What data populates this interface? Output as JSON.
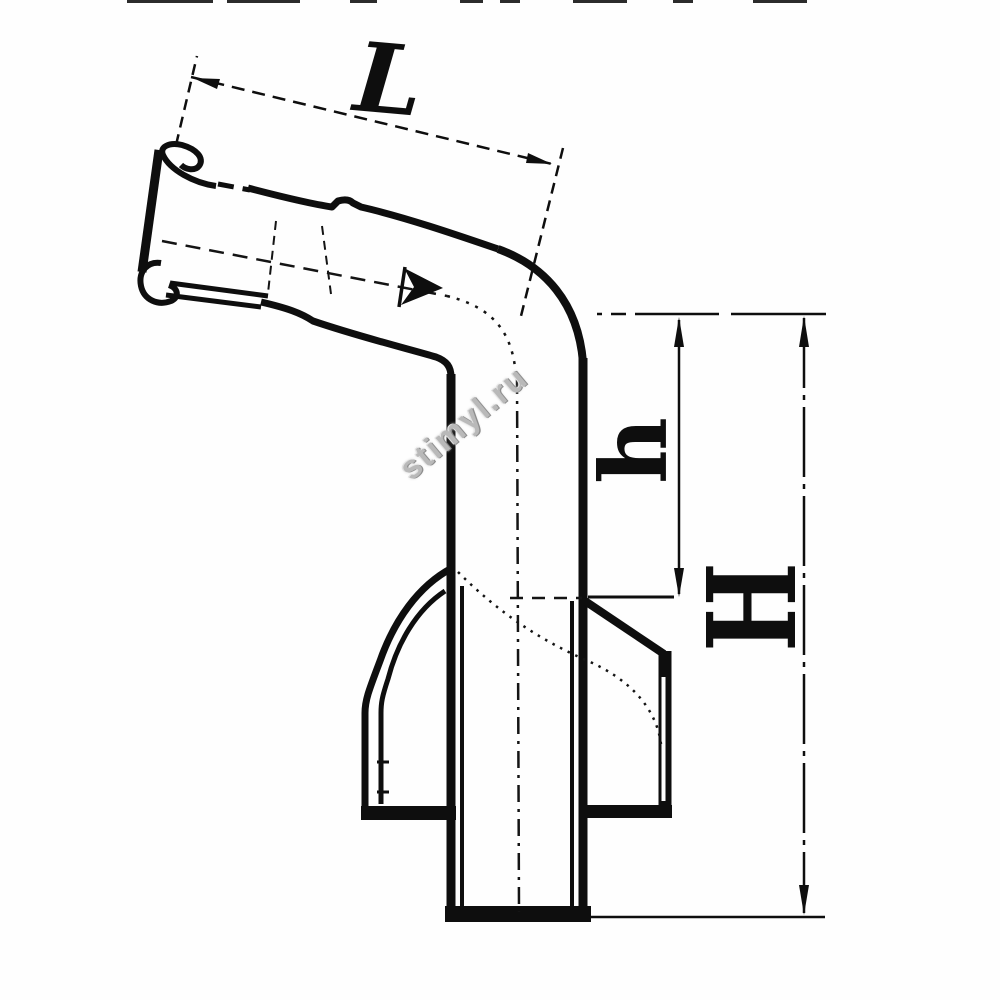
{
  "drawing": {
    "type": "technical-dimension-drawing",
    "subject": "angled drain pipe fitting, side section view",
    "labels": {
      "L": "L",
      "h": "h",
      "H": "H"
    },
    "watermark": {
      "text": "stimyl.ru",
      "color": "#b9b9b9"
    },
    "colors": {
      "line": "#0e0e0e",
      "background": "#fefefe"
    }
  }
}
